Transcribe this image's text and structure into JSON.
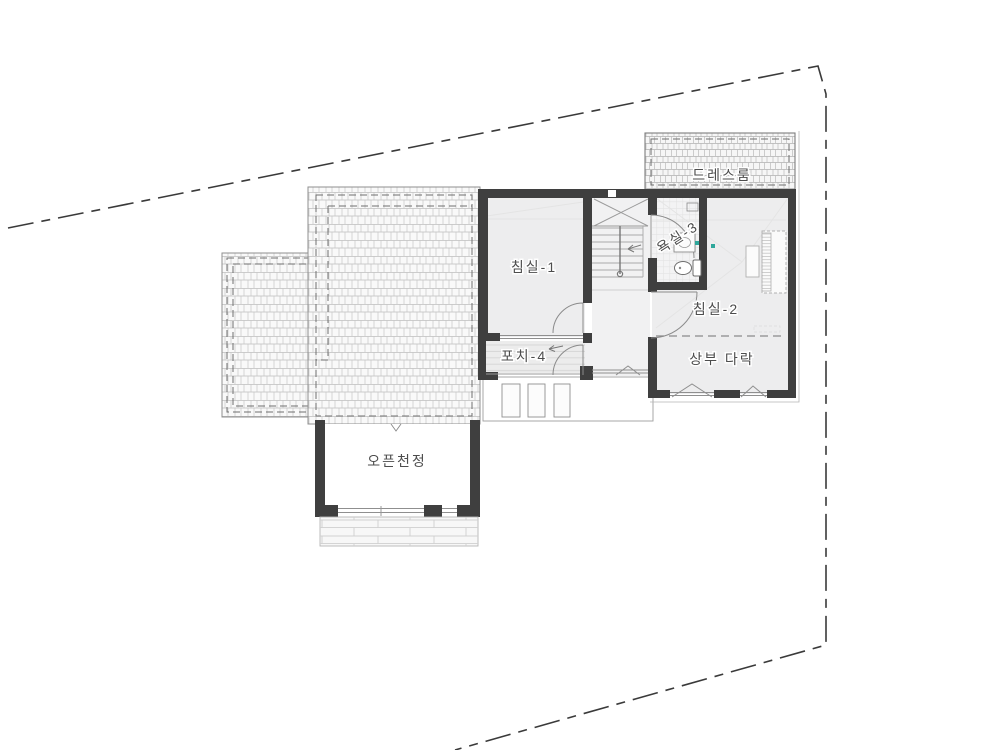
{
  "document": {
    "kind": "architectural-floor-plan",
    "background": "#ffffff"
  },
  "colors": {
    "wall": "#3f3f3f",
    "roof_hatch_line": "#b6b6b6",
    "roof_fill": "#f9f9f9",
    "room_fill": "#ededee",
    "dashed_inset": "#6e6e6e",
    "site_boundary": "#3a3a3a",
    "label_text": "#4d4d4d",
    "thin_line": "#9a9a9a",
    "faint_line": "#e4e4e4",
    "floor_plank_line": "#d6d6d6",
    "accent_teal": "#2fa79b"
  },
  "labels": {
    "bedroom1": "침실-1",
    "bedroom2": "침실-2",
    "bathroom3": "욕실-3",
    "dressroom": "드레스룸",
    "porch4": "포치-4",
    "upper_attic": "상부 다락",
    "open_ceiling": "오픈천정"
  }
}
